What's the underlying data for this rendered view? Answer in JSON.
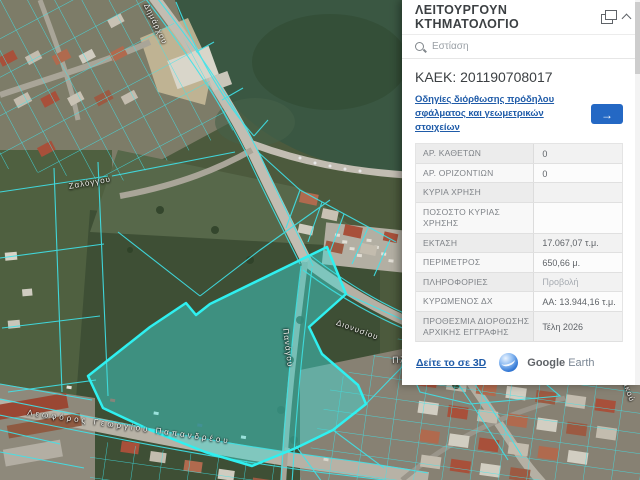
{
  "panel": {
    "title": "ΛΕΙΤΟΥΡΓΟΥΝ ΚΤΗΜΑΤΟΛΟΓΙΟ",
    "search_placeholder": "Εστίαση",
    "kaek": "ΚΑΕΚ: 201190708017",
    "correction_link": "Οδηγίες διόρθωσης πρόδηλου σφάλματος και γεωμετρικών στοιχείων",
    "arrow_button": "→",
    "rows": [
      {
        "label": "ΑΡ. ΚΑΘΕΤΩΝ",
        "value": "0"
      },
      {
        "label": "ΑΡ. ΟΡΙΖΟΝΤΙΩΝ",
        "value": "0"
      },
      {
        "label": "ΚΥΡΙΑ ΧΡΗΣΗ",
        "value": ""
      },
      {
        "label": "ΠΟΣΟΣΤΟ ΚΥΡΙΑΣ ΧΡΗΣΗΣ",
        "value": ""
      },
      {
        "label": "ΕΚΤΑΣΗ",
        "value": "17.067,07 τ.μ."
      },
      {
        "label": "ΠΕΡΙΜΕΤΡΟΣ",
        "value": "650,66 μ."
      },
      {
        "label": "ΠΛΗΡΟΦΟΡΙΕΣ",
        "value": "Προβολή"
      },
      {
        "label": "ΚΥΡΩΜΕΝΟΣ ΔΧ",
        "value": "ΑΑ: 13.944,16 τ.μ."
      },
      {
        "label": "ΠΡΟΘΕΣΜΙΑ ΔΙΟΡΘΩΣΗΣ ΑΡΧΙΚΗΣ ΕΓΓΡΑΦΗΣ",
        "value": "Τέλη 2026"
      }
    ],
    "view_3d_link": "Δείτε το σε 3D",
    "google": "Google",
    "earth": "Earth"
  },
  "map": {
    "labels": [
      {
        "text": "Δημάρχου"
      },
      {
        "text": "Ζαλόγγου"
      },
      {
        "text": "Διονυσίου"
      },
      {
        "text": "Διονυσίου"
      },
      {
        "text": "Πλατεία Μαβίλη"
      },
      {
        "text": "Λεωφόρος Γεωργίου Παπανδρέου"
      },
      {
        "text": "Πανάγου"
      },
      {
        "text": "Ιστορικού"
      }
    ]
  },
  "colors": {
    "accent_blue": "#2468c4",
    "link_blue": "#1f5ba8",
    "parcel_cyan": "#35e2ea",
    "highlight_fill": "rgba(62,224,220,0.45)"
  }
}
